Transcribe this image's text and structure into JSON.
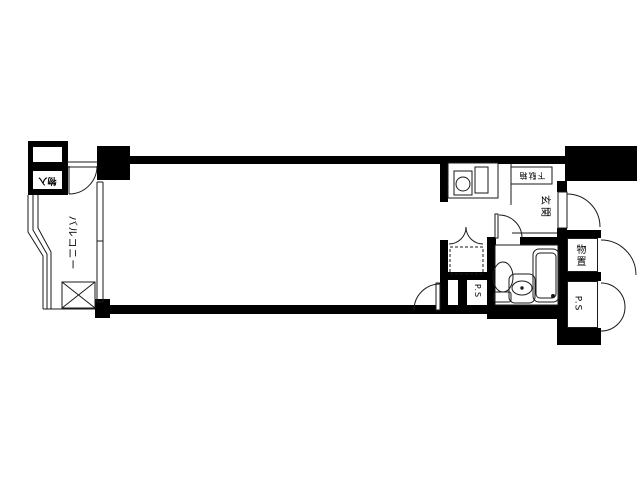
{
  "floorplan": {
    "background_color": "#ffffff",
    "wall_color": "#000000",
    "line_color": "#1a1a1a",
    "labels": {
      "balcony": "バルコニー",
      "balcony_storage": "物入",
      "shoe_cabinet": "下駄箱",
      "entrance": "玄関",
      "storage": "物置",
      "pipe_space_right": "P.S",
      "pipe_space_left": "P.S"
    }
  }
}
